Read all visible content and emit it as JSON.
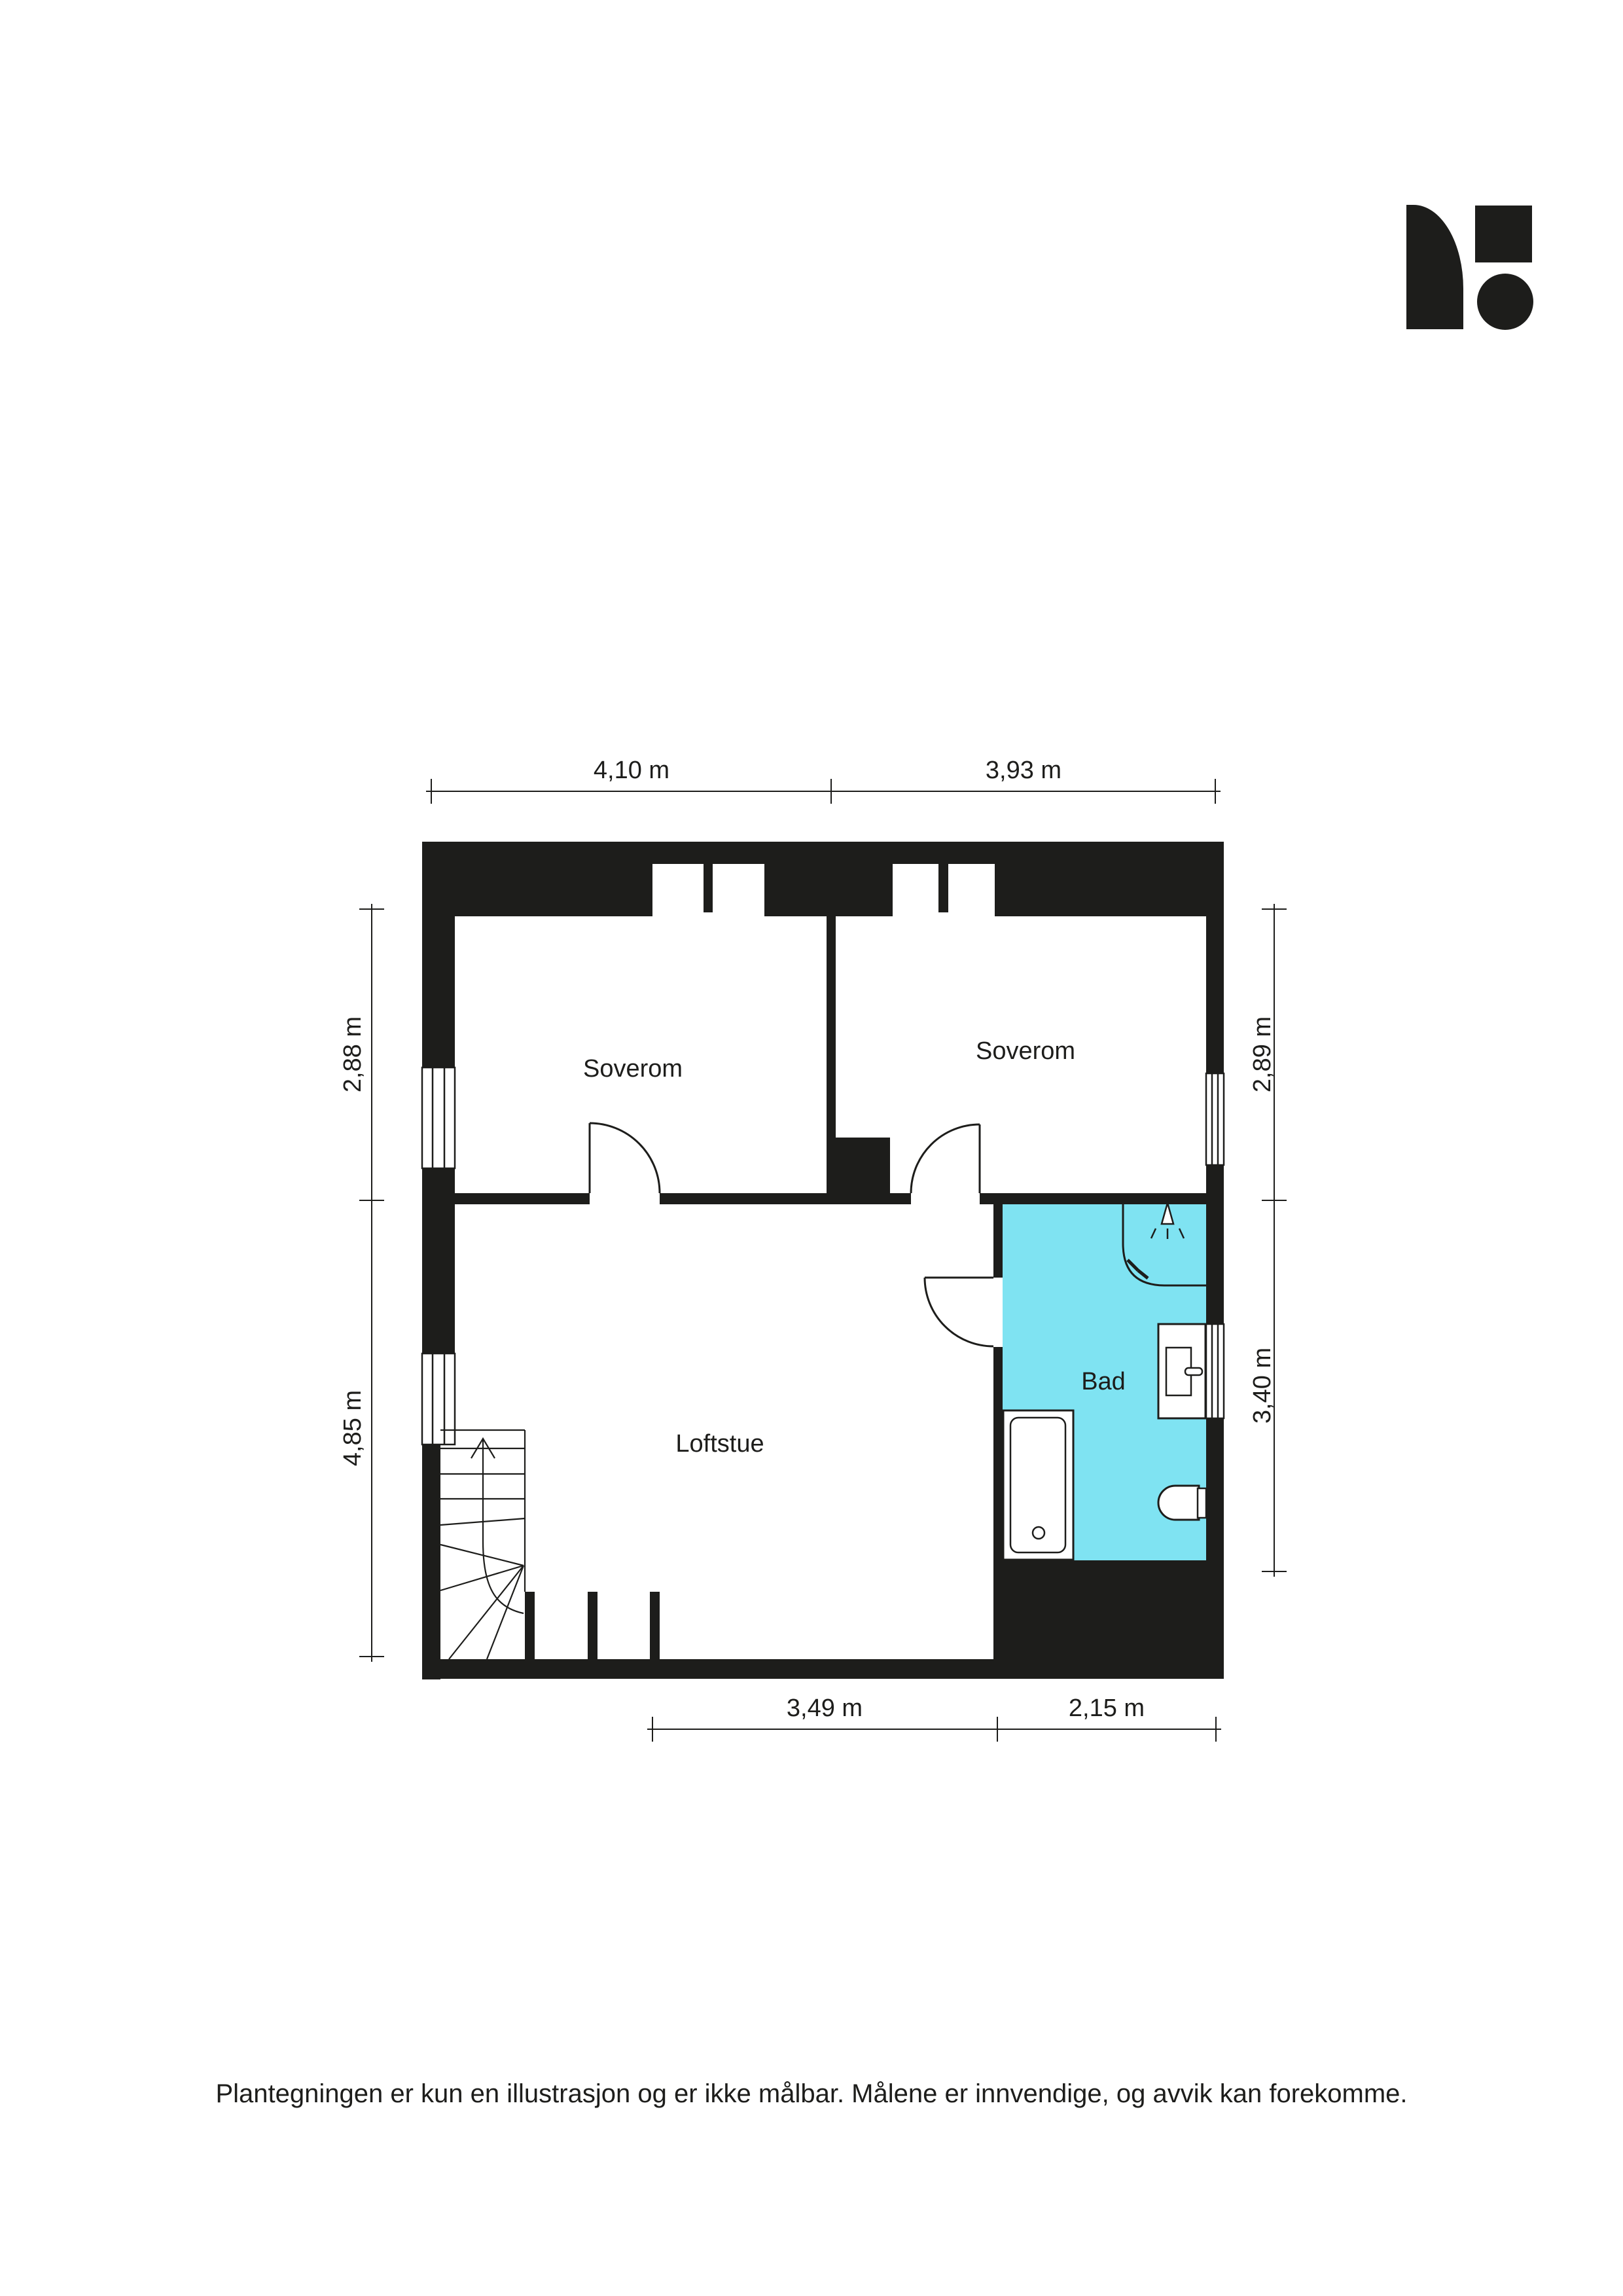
{
  "colors": {
    "wall": "#1d1d1b",
    "line": "#1d1d1b",
    "text": "#1d1d1b",
    "bathroom_floor": "#7fe3f2",
    "paper": "#ffffff"
  },
  "rooms": [
    {
      "id": "soverom-1",
      "label": "Soverom"
    },
    {
      "id": "soverom-2",
      "label": "Soverom"
    },
    {
      "id": "loftstue",
      "label": "Loftstue"
    },
    {
      "id": "bad",
      "label": "Bad"
    }
  ],
  "dimensions": {
    "top": [
      {
        "label": "4,10 m"
      },
      {
        "label": "3,93 m"
      }
    ],
    "left": [
      {
        "label": "2,88 m"
      },
      {
        "label": "4,85 m"
      }
    ],
    "right": [
      {
        "label": "2,89 m"
      },
      {
        "label": "3,40 m"
      }
    ],
    "bottom": [
      {
        "label": "3,49 m"
      },
      {
        "label": "2,15 m"
      }
    ]
  },
  "footer": {
    "disclaimer": "Plantegningen er kun en illustrasjon og er ikke målbar. Målene er innvendige, og avvik kan forekomme."
  }
}
